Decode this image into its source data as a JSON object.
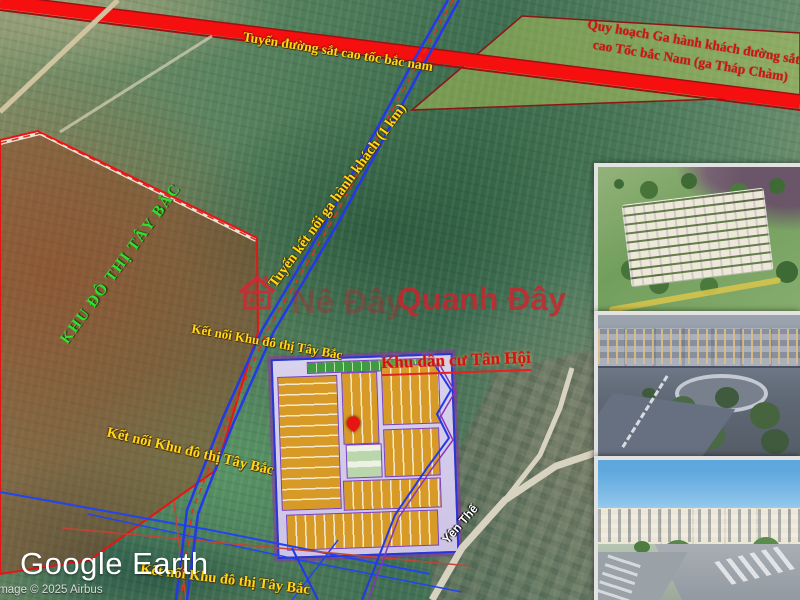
{
  "map": {
    "railway_label": "Tuyến đường sắt cao tốc bắc nam",
    "station_label_line1": "Quy hoạch Ga hành khách đường sắt",
    "station_label_line2": "cao Tốc bắc Nam (ga Tháp Chàm)",
    "connector_road_label": "Tuyến kết nối ga hành khách (1 km)",
    "west_zone_label": "KHU ĐÔ THỊ TÂY BẮC",
    "connect_label": "Kết nối Khu đô thị Tây Bắc",
    "residential_label": "Khu dân cư Tân Hội",
    "street_label": "Yên Thế"
  },
  "watermark": {
    "prefix": "Nê Đây",
    "brand": "Quanh Đây"
  },
  "branding": {
    "logo": "Google Earth",
    "copyright": "Image © 2025 Airbus"
  },
  "insets": [
    {
      "name": "aerial-masterplan-render"
    },
    {
      "name": "dusk-street-render"
    },
    {
      "name": "day-street-render"
    }
  ],
  "colors": {
    "railway_red": "#f50f0f",
    "plot_gold": "#d79a26",
    "road_blue": "#2438e8",
    "boundary_red": "#e81414",
    "label_yellow": "#ffd914",
    "zone_green": "#2ee12e",
    "station_fill": "rgba(190,210,90,0.45)"
  }
}
